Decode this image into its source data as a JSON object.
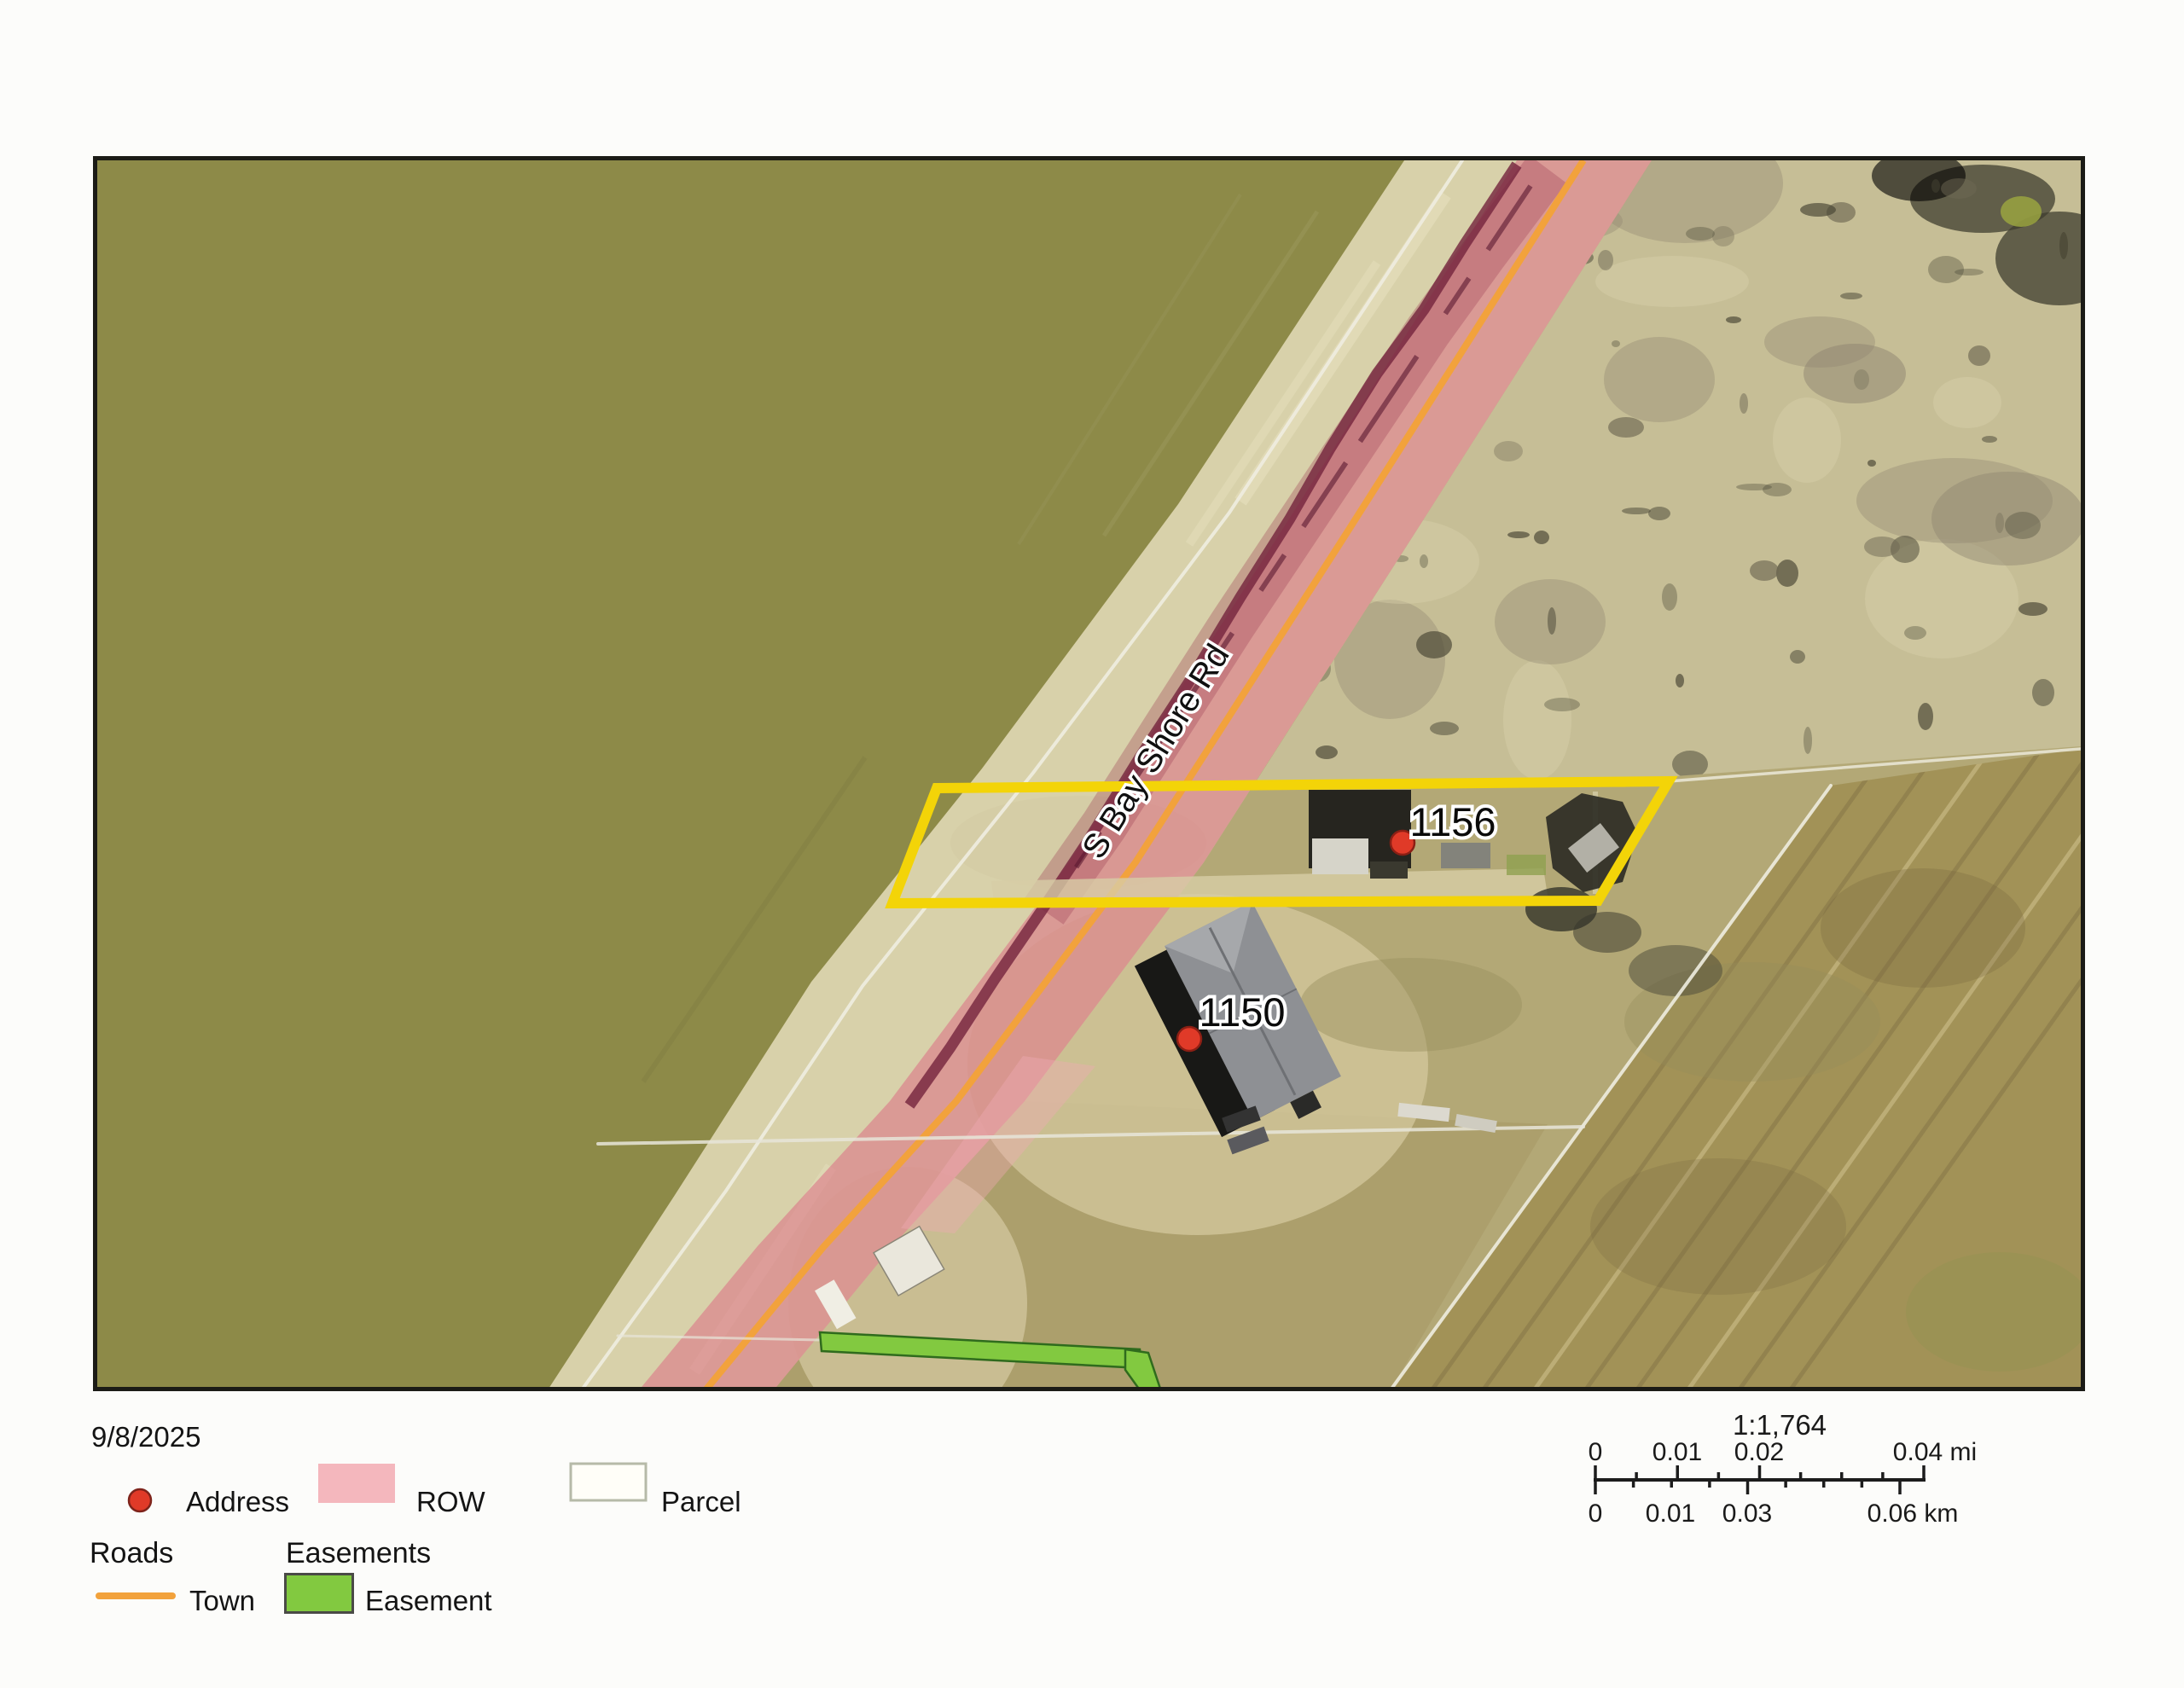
{
  "map": {
    "road_label": "S Bay Shore Rd",
    "addresses": [
      {
        "label": "1156"
      },
      {
        "label": "1150"
      }
    ]
  },
  "legend": {
    "date": "9/8/2025",
    "address_label": "Address",
    "row_label": "ROW",
    "parcel_label": "Parcel",
    "roads_header": "Roads",
    "town_label": "Town",
    "easements_header": "Easements",
    "easement_label": "Easement"
  },
  "scalebar": {
    "ratio": "1:1,764",
    "mi_labels": [
      "0",
      "0.01",
      "0.02",
      "0.04 mi"
    ],
    "km_labels": [
      "0",
      "0.01",
      "0.03",
      "0.06 km"
    ]
  },
  "colors": {
    "highlight_parcel": "#f3d408",
    "row_fill": "#dd6d84",
    "row_legend": "#f4b7bd",
    "town_road": "#f2a23c",
    "easement_green": "#82c940",
    "address_dot": "#e03a28",
    "parcel_line": "#efede0",
    "water": "#8d8a48"
  }
}
